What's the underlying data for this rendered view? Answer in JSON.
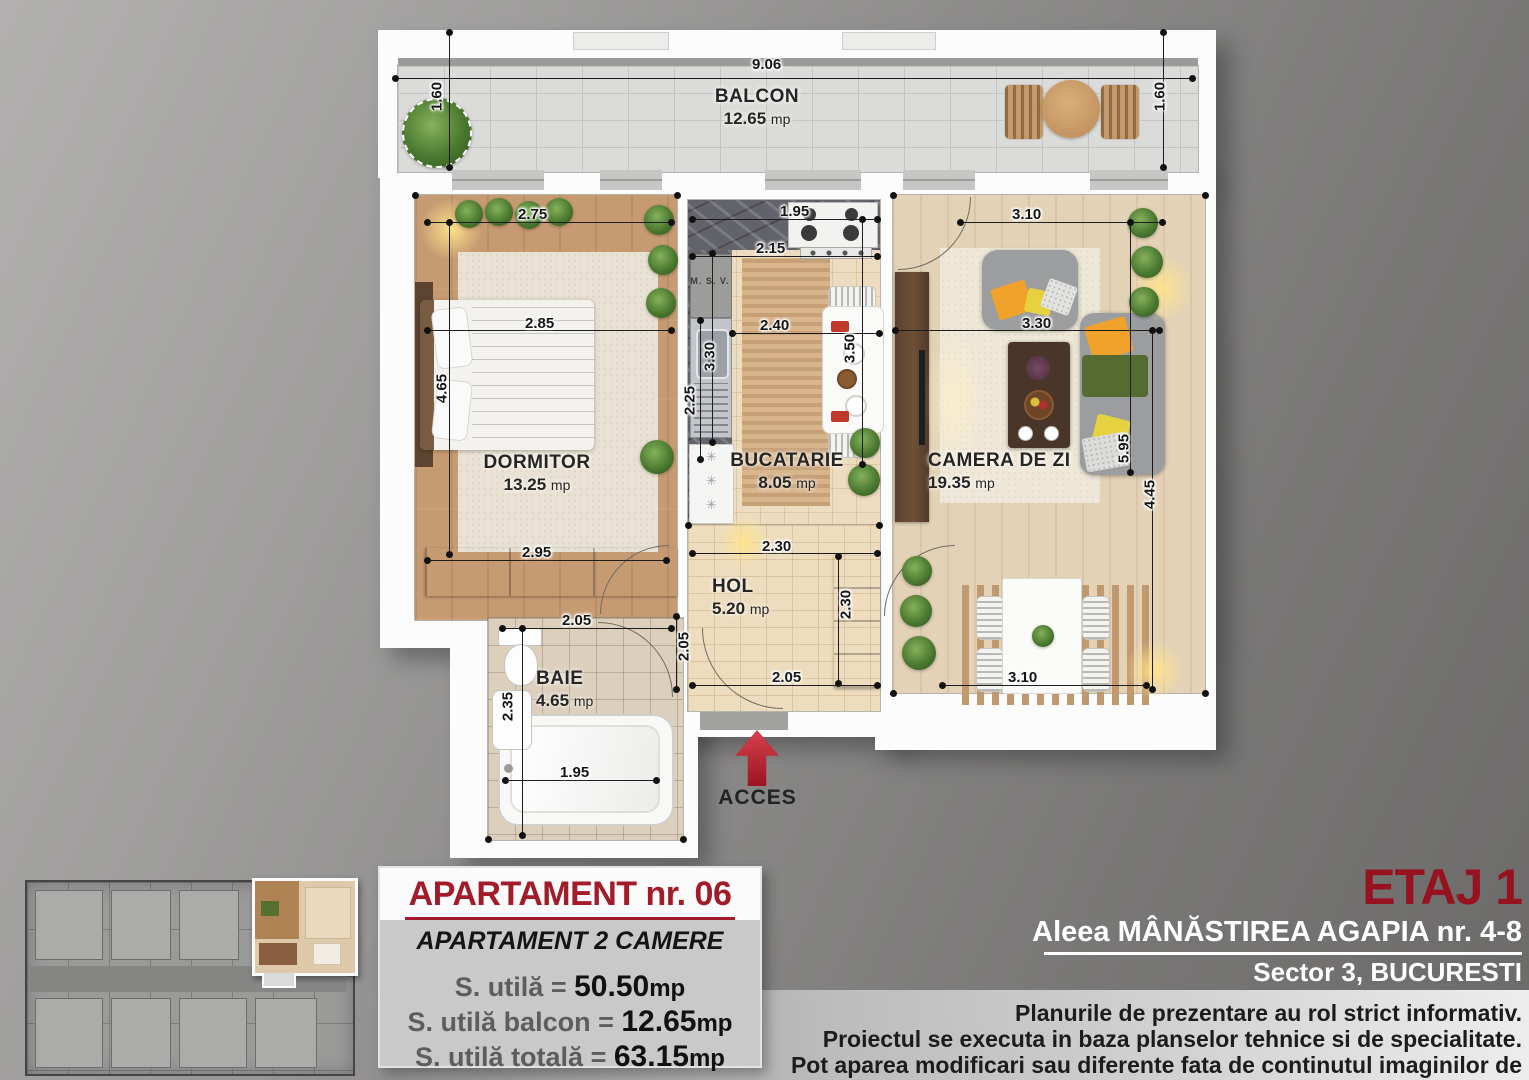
{
  "plan": {
    "rooms": {
      "balcon": {
        "name": "BALCON",
        "area": "12.65",
        "unit": "mp"
      },
      "dormitor": {
        "name": "DORMITOR",
        "area": "13.25",
        "unit": "mp"
      },
      "bucatarie": {
        "name": "BUCATARIE",
        "area": "8.05",
        "unit": "mp"
      },
      "camera": {
        "name": "CAMERA DE ZI",
        "area": "19.35",
        "unit": "mp"
      },
      "hol": {
        "name": "HOL",
        "area": "5.20",
        "unit": "mp"
      },
      "baie": {
        "name": "BAIE",
        "area": "4.65",
        "unit": "mp"
      }
    },
    "labels": {
      "msv": "M. S. V.",
      "acces": "ACCES"
    },
    "dims": {
      "balcony_width": "9.06",
      "balcony_depth_left": "1.60",
      "balcony_depth_right": "1.60",
      "dormitor_width_top": "2.75",
      "dormitor_width_bed": "2.85",
      "dormitor_height": "4.65",
      "dormitor_width_bottom": "2.95",
      "bucatarie_width_top": "1.95",
      "bucatarie_width_counter": "2.15",
      "bucatarie_width_mid": "2.40",
      "bucatarie_height_right": "3.50",
      "bucatarie_height_left_upper": "3.30",
      "bucatarie_height_left_lower": "2.25",
      "living_width_top": "3.10",
      "living_width_mid": "3.30",
      "living_height_inner": "5.95",
      "living_height_outer": "4.45",
      "living_width_bottom": "3.10",
      "hol_width_top": "2.30",
      "hol_height_right": "2.30",
      "hol_height_left": "2.05",
      "hol_width_bottom": "2.05",
      "baie_width_top": "2.05",
      "baie_height_left": "2.35",
      "baie_width_tub": "1.95"
    }
  },
  "info_box": {
    "title": "APARTAMENT nr. 06",
    "subtitle": "APARTAMENT 2 CAMERE",
    "rows": [
      {
        "label": "S. utilă =",
        "value": "50.50",
        "unit": "mp"
      },
      {
        "label": "S. utilă balcon =",
        "value": "12.65",
        "unit": "mp"
      },
      {
        "label": "S. utilă totală =",
        "value": "63.15",
        "unit": "mp"
      }
    ]
  },
  "right_panel": {
    "floor": "ETAJ 1",
    "address": "Aleea MÂNĂSTIREA AGAPIA nr. 4-8",
    "city": "Sector 3, BUCURESTI",
    "disclaimer": [
      "Planurile de prezentare au rol strict informativ.",
      "Proiectul se executa in baza planselor tehnice si de specialitate.",
      "Pot aparea modificari sau diferente fata de continutul imaginilor de prezentare."
    ]
  },
  "colors": {
    "accent_red": "#a11b28",
    "floor_red": "#97121f",
    "paper": "#fcfcfc"
  }
}
